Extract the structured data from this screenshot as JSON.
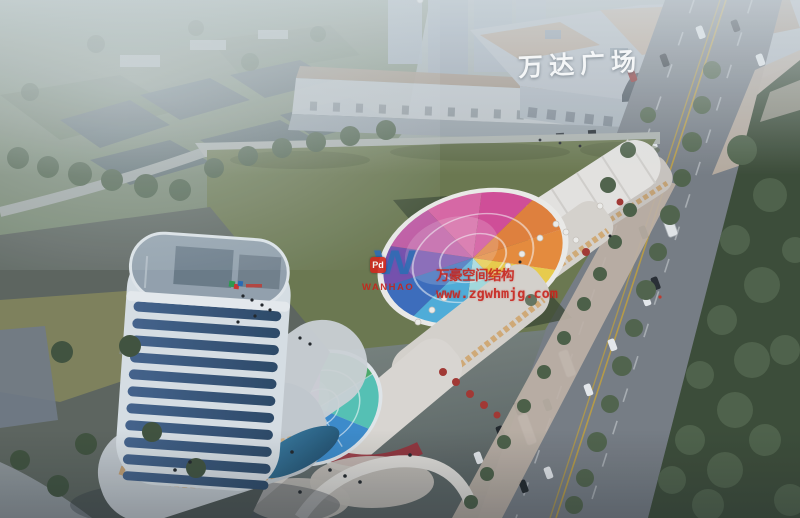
{
  "meta": {
    "kind": "aerial architectural rendering",
    "size": "800x518"
  },
  "signs": {
    "wanda_plaza": "万达广场"
  },
  "watermark": {
    "logo_monogram": "W",
    "logo_badge": "Pd",
    "logo_name": "WANHAO",
    "title": "万豪空间结构",
    "url": "www.zgwhmjg.com",
    "text_color": "#c9231b",
    "logo_blue": "#2e6db4",
    "badge_red": "#d0281e"
  },
  "colors": {
    "haze_sky": "#b7bfc6",
    "terrain_upper_left": "#78876e",
    "dark_sheds": "#5d6a6e",
    "field_green": "#6f7b50",
    "field_shadow": "#3c4832",
    "road_gray": "#7b8086",
    "sidewalk_tan": "#c2b2a4",
    "green_strip": "#3e4d37",
    "tree_green": "#4e6147",
    "mall_facade": "#b9bec4",
    "mall_roof_tan": "#b79d84",
    "shops_facade": "#c6cacd",
    "strip_building_white": "#e9e6e1",
    "plaza_band_tan": "#c4b6a9",
    "tower_band_white": "#dfe5e9",
    "tower_glass": "#3c5a7c",
    "plaza_dark": "#60675f",
    "umbrella_red": "#a83832",
    "pool_blue": "#2a6f96",
    "lane_yellow": "#c9a53c"
  }
}
